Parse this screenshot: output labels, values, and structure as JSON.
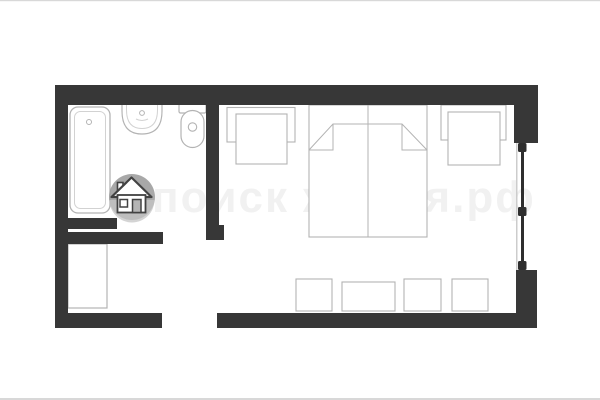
{
  "page": {
    "type": "floor-plan-image",
    "description": "studio-apartment-floor-plan"
  },
  "watermark": {
    "text": "поиск жилья.рф",
    "logo": "house-icon"
  },
  "colors": {
    "background": "#ffffff",
    "frame_line": "#d8d8d8",
    "wall": "#373737",
    "fixture_outline": "#b3b3b3",
    "fixture_outline_light": "#d2d2d2",
    "fixture_fill": "#ffffff",
    "window_frame": "#2e2e2e",
    "window_sill": "#cccccc",
    "watermark_text_color": "#f1f1f1",
    "logo_circle_top": "#9c9c9c",
    "logo_circle_bottom": "#c6c6c6",
    "logo_house_outline": "#424242",
    "logo_house_fill": "#ffffff",
    "logo_door_fill": "#b5b5b5"
  },
  "plan": {
    "canvas": {
      "width": 600,
      "height": 400
    },
    "elements": [
      {
        "name": "photo-frame-top-line",
        "interactable": false,
        "shapes": [
          {
            "tag": "rect",
            "attrs": {
              "x": 0,
              "y": 0,
              "width": 600,
              "height": 1.2,
              "fill": "$frame_line"
            }
          }
        ]
      },
      {
        "name": "photo-frame-bottom-line",
        "interactable": false,
        "shapes": [
          {
            "tag": "rect",
            "attrs": {
              "x": 0,
              "y": 398,
              "width": 600,
              "height": 2,
              "fill": "$frame_line"
            }
          }
        ]
      },
      {
        "name": "watermark-text",
        "interactable": false,
        "shapes": [
          {
            "tag": "text",
            "bind": "watermark.text",
            "attrs": {
              "x": 152,
              "y": 212,
              "font-size": 44,
              "letter-spacing": 2,
              "font-weight": 600,
              "fill": "$watermark_text_color",
              "font-family": "Liberation Sans, sans-serif"
            }
          }
        ]
      },
      {
        "name": "bathtub",
        "interactable": false,
        "shapes": [
          {
            "tag": "rect",
            "attrs": {
              "x": 70,
              "y": 107,
              "width": 40,
              "height": 106,
              "rx": 8,
              "fill": "$fixture_fill",
              "stroke": "$fixture_outline",
              "stroke-width": 1.3
            }
          },
          {
            "tag": "rect",
            "attrs": {
              "x": 74.5,
              "y": 111.5,
              "width": 31,
              "height": 97,
              "rx": 6,
              "fill": "none",
              "stroke": "$fixture_outline_light",
              "stroke-width": 1
            }
          },
          {
            "tag": "circle",
            "attrs": {
              "cx": 89,
              "cy": 122,
              "r": 2.5,
              "fill": "none",
              "stroke": "$fixture_outline",
              "stroke-width": 1
            }
          }
        ]
      },
      {
        "name": "sink",
        "interactable": false,
        "shapes": [
          {
            "tag": "path",
            "attrs": {
              "d": "M122,104 L122,111 Q122,134 142,134 Q162,134 162,111 L162,104 Z",
              "fill": "$fixture_fill",
              "stroke": "$fixture_outline",
              "stroke-width": 1.2
            }
          },
          {
            "tag": "path",
            "attrs": {
              "d": "M126.5,104 L126.5,110 Q126.5,128.5 142,128.5 Q157.5,128.5 157.5,110 L157.5,104",
              "fill": "none",
              "stroke": "$fixture_outline_light",
              "stroke-width": 1
            }
          },
          {
            "tag": "circle",
            "attrs": {
              "cx": 142,
              "cy": 113,
              "r": 2.4,
              "fill": "$fixture_fill",
              "stroke": "$fixture_outline",
              "stroke-width": 1
            }
          },
          {
            "tag": "path",
            "attrs": {
              "d": "M136,119 Q142,122 148,119",
              "fill": "none",
              "stroke": "$fixture_outline_light",
              "stroke-width": 1
            }
          }
        ]
      },
      {
        "name": "toilet",
        "interactable": false,
        "shapes": [
          {
            "tag": "rect",
            "attrs": {
              "x": 179,
              "y": 104,
              "width": 27,
              "height": 9,
              "rx": 1.5,
              "fill": "$fixture_fill",
              "stroke": "$fixture_outline",
              "stroke-width": 1.2
            }
          },
          {
            "tag": "rect",
            "attrs": {
              "x": 181,
              "y": 110.5,
              "width": 23,
              "height": 37,
              "rx": 11.5,
              "fill": "$fixture_fill",
              "stroke": "$fixture_outline",
              "stroke-width": 1.2
            }
          },
          {
            "tag": "circle",
            "attrs": {
              "cx": 192.5,
              "cy": 127,
              "r": 4.2,
              "fill": "$fixture_fill",
              "stroke": "$fixture_outline",
              "stroke-width": 1.1
            }
          }
        ]
      },
      {
        "name": "wardrobe",
        "interactable": false,
        "shapes": [
          {
            "tag": "rect",
            "attrs": {
              "x": 68,
              "y": 244,
              "width": 39,
              "height": 64,
              "fill": "$fixture_fill",
              "stroke": "$fixture_outline",
              "stroke-width": 1.2
            }
          }
        ]
      },
      {
        "name": "armchair-left",
        "interactable": false,
        "shapes": [
          {
            "tag": "rect",
            "attrs": {
              "x": 227,
              "y": 107.5,
              "width": 68,
              "height": 34.5,
              "fill": "$fixture_fill",
              "stroke": "$fixture_outline",
              "stroke-width": 1.1
            }
          },
          {
            "tag": "rect",
            "attrs": {
              "x": 236,
              "y": 114,
              "width": 51,
              "height": 50,
              "fill": "$fixture_fill",
              "stroke": "$fixture_outline",
              "stroke-width": 1.1
            }
          }
        ]
      },
      {
        "name": "double-bed",
        "interactable": false,
        "shapes": [
          {
            "tag": "rect",
            "attrs": {
              "x": 309,
              "y": 105,
              "width": 118,
              "height": 132,
              "fill": "$fixture_fill",
              "stroke": "$fixture_outline",
              "stroke-width": 1.1
            }
          },
          {
            "tag": "line",
            "attrs": {
              "x1": 368,
              "y1": 105,
              "x2": 368,
              "y2": 237,
              "stroke": "$fixture_outline",
              "stroke-width": 1
            }
          },
          {
            "tag": "path",
            "attrs": {
              "d": "M309,150 L333,124 L402,124 L427,150",
              "fill": "none",
              "stroke": "$fixture_outline",
              "stroke-width": 1
            }
          },
          {
            "tag": "path",
            "attrs": {
              "d": "M333,124 L333,150 L309,150",
              "fill": "none",
              "stroke": "$fixture_outline",
              "stroke-width": 1
            }
          },
          {
            "tag": "path",
            "attrs": {
              "d": "M402,124 L402,150 L427,150",
              "fill": "none",
              "stroke": "$fixture_outline",
              "stroke-width": 1
            }
          }
        ]
      },
      {
        "name": "armchair-right",
        "interactable": false,
        "shapes": [
          {
            "tag": "rect",
            "attrs": {
              "x": 441,
              "y": 105,
              "width": 65,
              "height": 35,
              "fill": "$fixture_fill",
              "stroke": "$fixture_outline",
              "stroke-width": 1.1
            }
          },
          {
            "tag": "rect",
            "attrs": {
              "x": 448,
              "y": 112,
              "width": 52,
              "height": 53,
              "fill": "$fixture_fill",
              "stroke": "$fixture_outline",
              "stroke-width": 1.1
            }
          }
        ]
      },
      {
        "name": "stool-1",
        "interactable": false,
        "shapes": [
          {
            "tag": "rect",
            "attrs": {
              "x": 296,
              "y": 279,
              "width": 36,
              "height": 32,
              "fill": "$fixture_fill",
              "stroke": "$fixture_outline",
              "stroke-width": 1.1
            }
          }
        ]
      },
      {
        "name": "table",
        "interactable": false,
        "shapes": [
          {
            "tag": "rect",
            "attrs": {
              "x": 342,
              "y": 282,
              "width": 53,
              "height": 29,
              "fill": "$fixture_fill",
              "stroke": "$fixture_outline",
              "stroke-width": 1.1
            }
          }
        ]
      },
      {
        "name": "stool-2",
        "interactable": false,
        "shapes": [
          {
            "tag": "rect",
            "attrs": {
              "x": 404,
              "y": 279,
              "width": 37,
              "height": 32,
              "fill": "$fixture_fill",
              "stroke": "$fixture_outline",
              "stroke-width": 1.1
            }
          }
        ]
      },
      {
        "name": "stool-3",
        "interactable": false,
        "shapes": [
          {
            "tag": "rect",
            "attrs": {
              "x": 452,
              "y": 279,
              "width": 36,
              "height": 32,
              "fill": "$fixture_fill",
              "stroke": "$fixture_outline",
              "stroke-width": 1.1
            }
          }
        ]
      },
      {
        "name": "wall-top",
        "interactable": false,
        "shapes": [
          {
            "tag": "rect",
            "attrs": {
              "x": 55,
              "y": 85,
              "width": 483,
              "height": 20,
              "fill": "$wall"
            }
          }
        ]
      },
      {
        "name": "wall-left",
        "interactable": false,
        "shapes": [
          {
            "tag": "rect",
            "attrs": {
              "x": 55,
              "y": 85,
              "width": 13,
              "height": 243,
              "fill": "$wall"
            }
          }
        ]
      },
      {
        "name": "wall-bottom-left",
        "interactable": false,
        "shapes": [
          {
            "tag": "rect",
            "attrs": {
              "x": 55,
              "y": 313,
              "width": 107,
              "height": 15,
              "fill": "$wall"
            }
          }
        ]
      },
      {
        "name": "wall-bottom-right",
        "interactable": false,
        "shapes": [
          {
            "tag": "rect",
            "attrs": {
              "x": 217,
              "y": 313,
              "width": 320,
              "height": 15,
              "fill": "$wall"
            }
          }
        ]
      },
      {
        "name": "wall-right-upper",
        "interactable": false,
        "shapes": [
          {
            "tag": "rect",
            "attrs": {
              "x": 514,
              "y": 85,
              "width": 24,
              "height": 58,
              "fill": "$wall"
            }
          }
        ]
      },
      {
        "name": "wall-right-lower",
        "interactable": false,
        "shapes": [
          {
            "tag": "rect",
            "attrs": {
              "x": 516,
              "y": 270,
              "width": 21,
              "height": 58,
              "fill": "$wall"
            }
          }
        ]
      },
      {
        "name": "wall-bathroom-right",
        "interactable": false,
        "shapes": [
          {
            "tag": "rect",
            "attrs": {
              "x": 206,
              "y": 105,
              "width": 13,
              "height": 123,
              "fill": "$wall"
            }
          },
          {
            "tag": "rect",
            "attrs": {
              "x": 206,
              "y": 225,
              "width": 18,
              "height": 15,
              "fill": "$wall"
            }
          }
        ]
      },
      {
        "name": "wall-bathroom-bottom",
        "interactable": false,
        "shapes": [
          {
            "tag": "rect",
            "attrs": {
              "x": 65,
              "y": 232,
              "width": 98,
              "height": 12,
              "fill": "$wall"
            }
          }
        ]
      },
      {
        "name": "bathroom-door-panel",
        "interactable": false,
        "shapes": [
          {
            "tag": "rect",
            "attrs": {
              "x": 65,
              "y": 218,
              "width": 52,
              "height": 11,
              "fill": "$wall"
            }
          }
        ]
      },
      {
        "name": "window-right",
        "interactable": false,
        "shapes": [
          {
            "tag": "rect",
            "attrs": {
              "x": 516,
              "y": 143,
              "width": 1.5,
              "height": 127,
              "fill": "$window_sill"
            }
          },
          {
            "tag": "rect",
            "attrs": {
              "x": 521,
              "y": 145,
              "width": 3,
              "height": 122,
              "fill": "$window_frame"
            }
          },
          {
            "tag": "rect",
            "attrs": {
              "x": 518,
              "y": 143,
              "width": 8.5,
              "height": 9,
              "rx": 1.5,
              "fill": "$window_frame"
            }
          },
          {
            "tag": "rect",
            "attrs": {
              "x": 518,
              "y": 207,
              "width": 8.5,
              "height": 9,
              "rx": 1.5,
              "fill": "$window_frame"
            }
          },
          {
            "tag": "rect",
            "attrs": {
              "x": 518,
              "y": 261,
              "width": 8.5,
              "height": 9,
              "rx": 1.5,
              "fill": "$window_frame"
            }
          }
        ]
      },
      {
        "name": "house-icon",
        "interactable": false,
        "shapes": [
          {
            "tag": "circle",
            "attrs": {
              "cx": 132,
              "cy": 197,
              "r": 23,
              "fill": "$logo_circle_top",
              "opacity": 0.88
            }
          },
          {
            "tag": "path",
            "attrs": {
              "d": "M109.5,200 A22.5,22.5 0 0 0 154.5,200 Z",
              "fill": "$logo_circle_bottom",
              "opacity": 0.75
            }
          },
          {
            "tag": "rect",
            "attrs": {
              "x": 117.5,
              "y": 182.5,
              "width": 5.5,
              "height": 9,
              "fill": "$logo_house_fill",
              "stroke": "$logo_house_outline",
              "stroke-width": 1.6
            }
          },
          {
            "tag": "path",
            "attrs": {
              "d": "M111.5,197 L131.5,177.5 L151.5,197 Z",
              "fill": "$logo_house_fill",
              "stroke": "$logo_house_outline",
              "stroke-width": 2.2,
              "stroke-linejoin": "round"
            }
          },
          {
            "tag": "rect",
            "attrs": {
              "x": 117.5,
              "y": 195,
              "width": 28,
              "height": 17.5,
              "fill": "$logo_house_fill",
              "stroke": "$logo_house_outline",
              "stroke-width": 1.8
            }
          },
          {
            "tag": "rect",
            "attrs": {
              "x": 120,
              "y": 199.5,
              "width": 7.5,
              "height": 7.5,
              "fill": "$logo_house_fill",
              "stroke": "$logo_house_outline",
              "stroke-width": 1.5
            }
          },
          {
            "tag": "rect",
            "attrs": {
              "x": 132.5,
              "y": 199.5,
              "width": 8.5,
              "height": 13,
              "fill": "$logo_door_fill",
              "stroke": "$logo_house_outline",
              "stroke-width": 1.5
            }
          }
        ]
      }
    ]
  }
}
